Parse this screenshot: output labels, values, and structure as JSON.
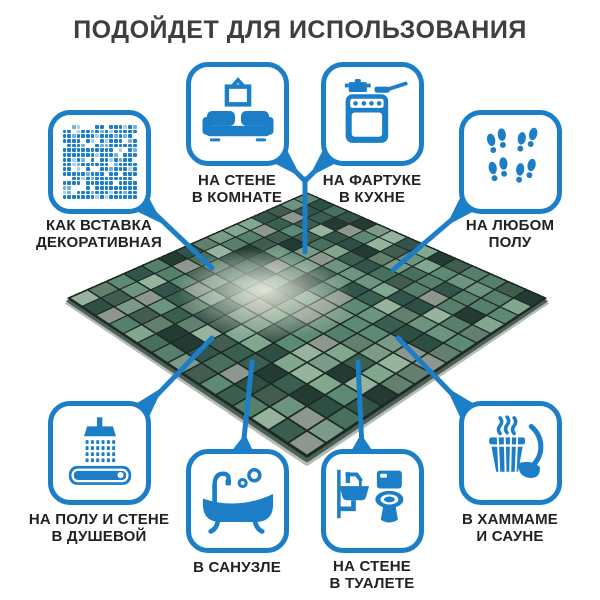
{
  "title": "ПОДОЙДЕТ ДЛЯ ИСПОЛЬЗОВАНИЯ",
  "callouts": {
    "decorative_insert": {
      "label": "КАК ВСТАВКА\nДЕКОРАТИВНАЯ",
      "icon": "mosaic-pattern-icon"
    },
    "room_wall": {
      "label": "НА СТЕНЕ\nВ КОМНАТЕ",
      "icon": "sofa-picture-icon"
    },
    "kitchen_backsplash": {
      "label": "НА ФАРТУКЕ\nВ КУХНЕ",
      "icon": "stove-icon"
    },
    "any_floor": {
      "label": "НА ЛЮБОМ\nПОЛУ",
      "icon": "footprints-icon"
    },
    "shower": {
      "label": "НА ПОЛУ И СТЕНЕ\nВ ДУШЕВОЙ",
      "icon": "shower-icon"
    },
    "bathroom": {
      "label": "В САНУЗЛЕ",
      "icon": "bathtub-icon"
    },
    "toilet": {
      "label": "НА СТЕНЕ\nВ ТУАЛЕТЕ",
      "icon": "toilet-sink-icon"
    },
    "sauna": {
      "label": "В ХАММАМЕ\nИ САУНЕ",
      "icon": "sauna-bucket-icon"
    }
  },
  "colors": {
    "accent_blue": "#1b7ec6",
    "accent_light": "#6fb0e0",
    "accent_lighter": "#a9cfee",
    "title_text": "#3e3e3d",
    "label_text": "#222222",
    "grout": "#1c2a24",
    "tile_palette": [
      "#49705f",
      "#3a5f50",
      "#2e4f44",
      "#567f6c",
      "#6d947f",
      "#82a78f",
      "#97b39e",
      "#425c50",
      "#243b33",
      "#5c8a74",
      "#7b9a88",
      "#33544a",
      "#8d978e",
      "#63806f"
    ]
  },
  "mosaic": {
    "rows": 15,
    "cols": 15
  }
}
